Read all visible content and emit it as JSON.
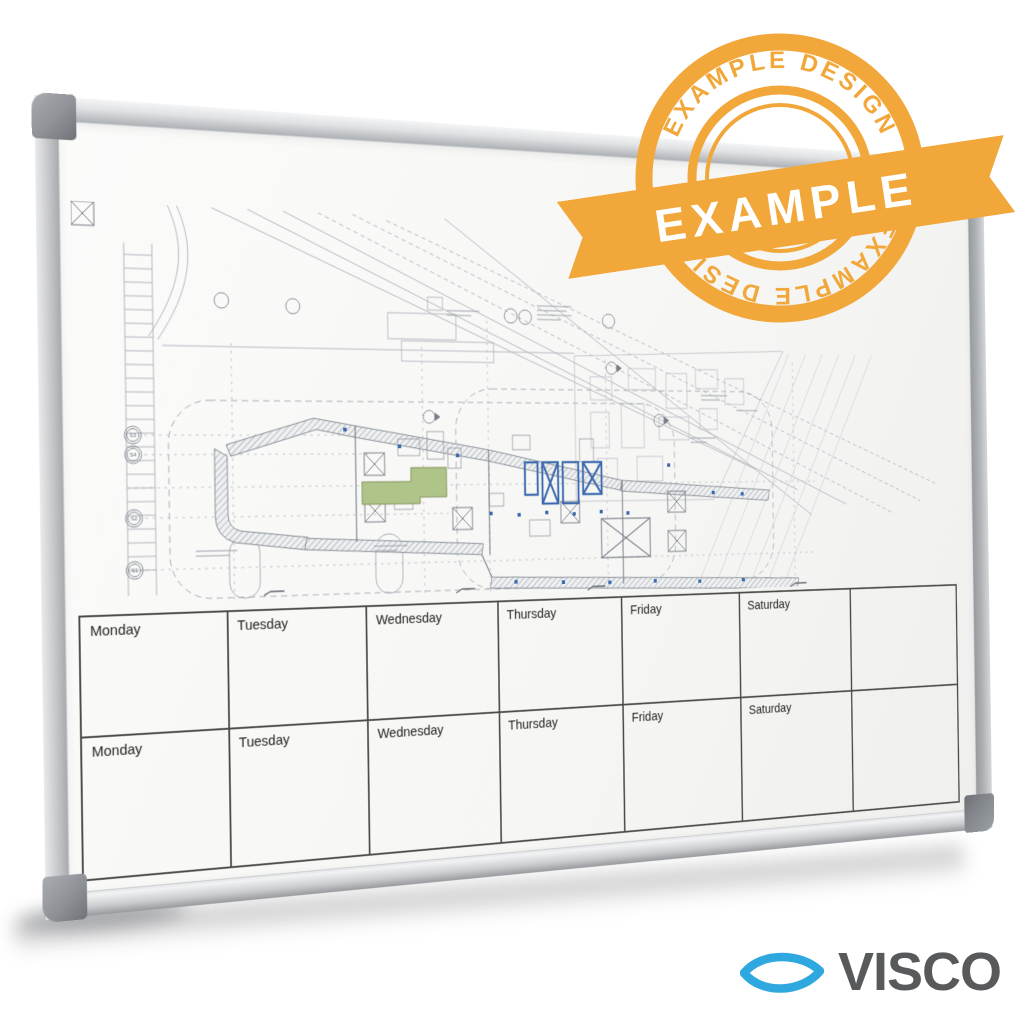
{
  "badge": {
    "arc_text": "EXAMPLE DESIGN",
    "ribbon_text": "EXAMPLE",
    "color": "#F2A73B",
    "ribbon_text_color": "#FFFFFF"
  },
  "calendar": {
    "row1": [
      "Monday",
      "Tuesday",
      "Wednesday",
      "Thursday",
      "Friday",
      "Saturday",
      ""
    ],
    "row2": [
      "Monday",
      "Tuesday",
      "Wednesday",
      "Thursday",
      "Friday",
      "Saturday",
      ""
    ]
  },
  "drawing": {
    "grid_markers": [
      "S3",
      "S4",
      "S2",
      "S1"
    ],
    "highlight_green": "#AEC488",
    "core_blue": "#3A69AE"
  },
  "logo": {
    "text": "VISCO",
    "icon": "lens-eye",
    "icon_color": "#2FA8E0",
    "text_color": "#58595B"
  },
  "board": {
    "frame_color": "#C3C5C8",
    "surface_color": "#F7F7F5"
  }
}
